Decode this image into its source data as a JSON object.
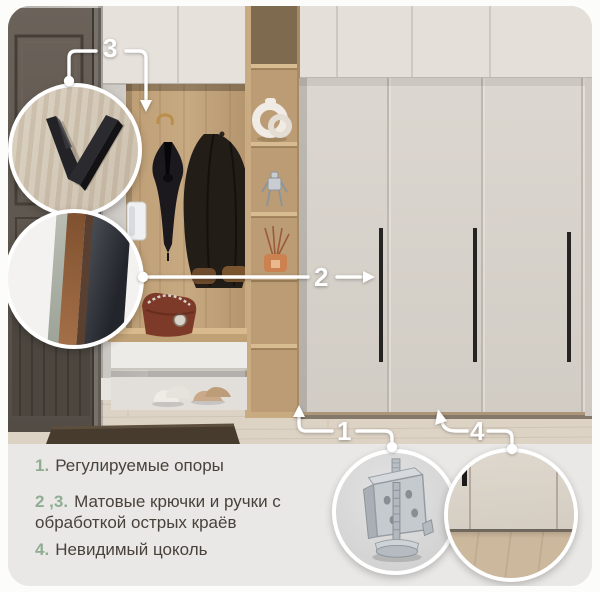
{
  "callouts": {
    "c1": "1",
    "c2": "2",
    "c3": "3",
    "c4": "4"
  },
  "features": [
    {
      "num": "1.",
      "text": "Регулируемые опоры"
    },
    {
      "num": "2 ,3.",
      "text": "Матовые крючки и ручки с обработкой острых краёв"
    },
    {
      "num": "4.",
      "text": "Невидимый цоколь"
    }
  ],
  "colors": {
    "accent_number_green": "#8fad93",
    "body_text": "#49423b",
    "panel_background": "#e9e8e6",
    "callout_white": "#ffffff",
    "wardrobe_door": "#d8d3cc",
    "wood_oak": "#c5a77e"
  }
}
